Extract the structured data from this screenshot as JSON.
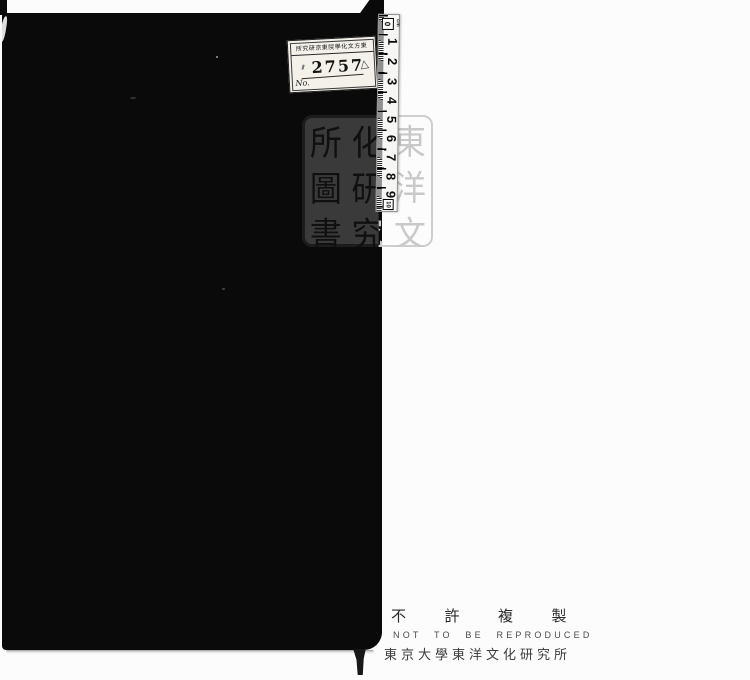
{
  "label": {
    "header": "所究硏京東院學化文方東",
    "number": "2757",
    "mark": "△",
    "no": "No."
  },
  "ruler": {
    "zero": "0",
    "unit": "cm",
    "marks": [
      "1",
      "2",
      "3",
      "4",
      "5",
      "6",
      "7",
      "8",
      "9"
    ],
    "end": "10"
  },
  "seal": {
    "reading": "東洋文化研究所圖書",
    "columns": [
      [
        "所",
        "圖",
        "書"
      ],
      [
        "化",
        "研",
        "究"
      ],
      [
        "東",
        "洋",
        "文"
      ]
    ]
  },
  "footer": {
    "notice_ja": "不許複製",
    "notice_en": "NOT TO BE REPRODUCED",
    "institution": "東京大學東洋文化研究所"
  },
  "colors": {
    "cover": "#0a0a0a",
    "page": "#fcfcfc",
    "seal_on_cover_panel": "#3a3a3a",
    "seal_on_paper_ink": "#c9c9c9",
    "footer_text": "#3c3c3c"
  }
}
